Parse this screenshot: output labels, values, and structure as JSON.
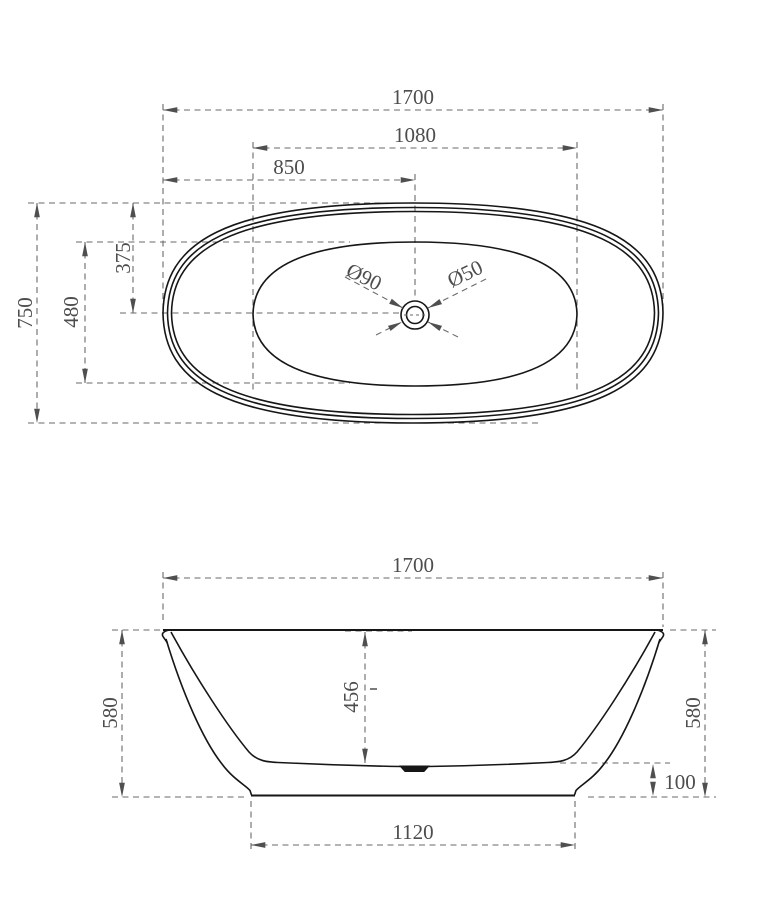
{
  "drawing": {
    "colors": {
      "outline": "#161616",
      "dimension": "#6a6a6a",
      "dim_text": "#4d4d4d"
    },
    "top_view": {
      "overall_length": "1700",
      "basin_length": "1080",
      "drain_offset_from_end": "850",
      "overall_width": "750",
      "basin_width": "480",
      "drain_offset_from_side": "375",
      "drain_flange_diameter": "Ø90",
      "drain_hole_diameter": "Ø50"
    },
    "front_view": {
      "overall_length": "1700",
      "overall_height_left": "580",
      "inner_depth": "456",
      "overall_height_right": "580",
      "base_height": "100",
      "base_length": "1120"
    }
  }
}
